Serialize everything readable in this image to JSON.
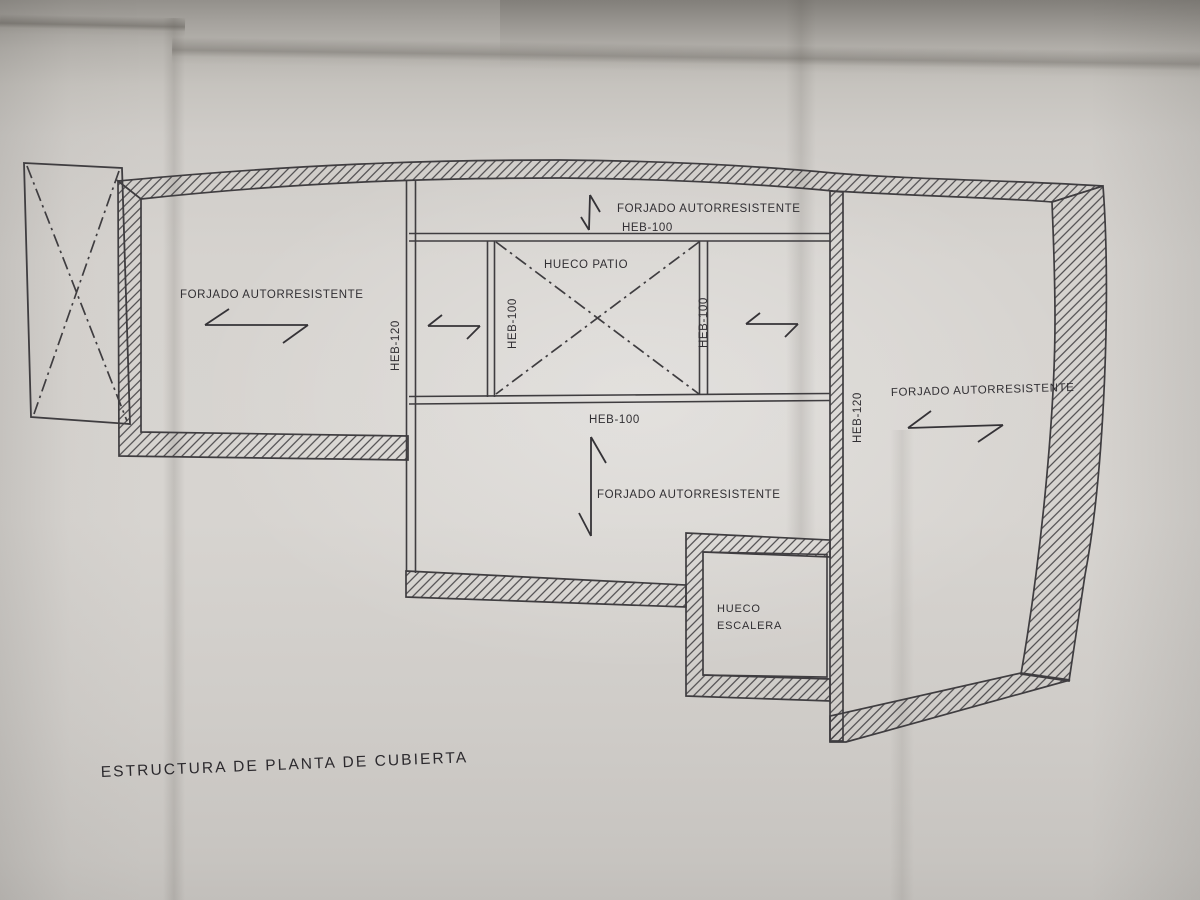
{
  "plan": {
    "title": "ESTRUCTURA DE PLANTA DE CUBIERTA",
    "slab_label": "FORJADO AUTORRESISTENTE",
    "beams": {
      "heb100": "HEB-100",
      "heb120": "HEB-120"
    },
    "openings": {
      "patio": "HUECO PATIO",
      "stair_line1": "HUECO",
      "stair_line2": "ESCALERA"
    },
    "colors": {
      "ink": "#3f3d40",
      "paper": "#d6d3cf"
    }
  }
}
